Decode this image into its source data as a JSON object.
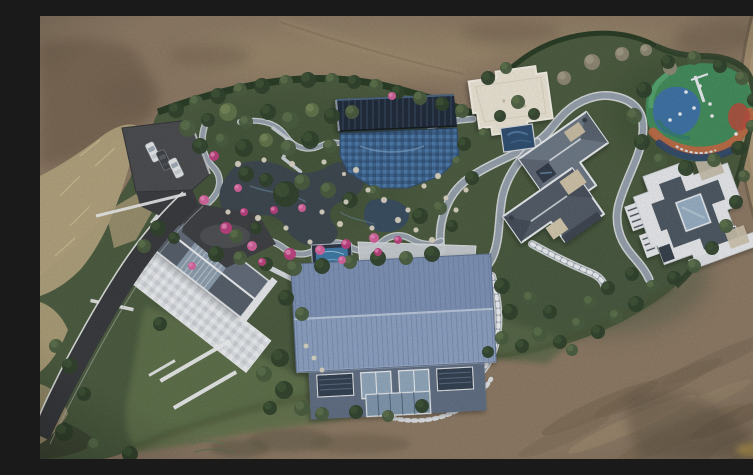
{
  "scene": {
    "description": "Top-down aerial drone photograph of a landscaped private estate: brown earth fields surround a hedged compound containing a rock-edged koi pond garden with pink azaleas, a dark ribbed pavilion, a blue tiled pool, a cream flat-roofed hall, a colorful rubber playground, two gray hip-roof villas, a diagonal gable house with white mosaic terrace, a large blue metal-roof barn, winding gray paths, an asphalt driveway with three parked cars and a dirt road on the right edge",
    "trees": [
      [
        136,
        94,
        8,
        "t1"
      ],
      [
        156,
        86,
        7,
        "t2"
      ],
      [
        178,
        80,
        8,
        "t1"
      ],
      [
        200,
        74,
        7,
        "t2"
      ],
      [
        222,
        70,
        8,
        "t1"
      ],
      [
        246,
        66,
        7,
        "t2"
      ],
      [
        268,
        64,
        8,
        "t1"
      ],
      [
        292,
        64,
        7,
        "t2"
      ],
      [
        314,
        66,
        7,
        "t1"
      ],
      [
        336,
        70,
        7,
        "t2"
      ],
      [
        358,
        76,
        7,
        "t1"
      ],
      [
        380,
        82,
        7,
        "t2"
      ],
      [
        402,
        88,
        7,
        "t1"
      ],
      [
        422,
        95,
        7,
        "t2"
      ],
      [
        148,
        112,
        9,
        "t2"
      ],
      [
        168,
        104,
        7,
        "t1"
      ],
      [
        188,
        96,
        9,
        "t3"
      ],
      [
        206,
        106,
        7,
        "t2"
      ],
      [
        228,
        96,
        8,
        "t1"
      ],
      [
        250,
        104,
        9,
        "t2"
      ],
      [
        272,
        94,
        7,
        "t3"
      ],
      [
        292,
        100,
        8,
        "t1"
      ],
      [
        312,
        96,
        7,
        "t2"
      ],
      [
        160,
        130,
        8,
        "t1"
      ],
      [
        182,
        124,
        7,
        "t2"
      ],
      [
        204,
        132,
        9,
        "t1"
      ],
      [
        226,
        124,
        7,
        "t3"
      ],
      [
        248,
        132,
        8,
        "t2"
      ],
      [
        270,
        124,
        9,
        "t1"
      ],
      [
        290,
        130,
        7,
        "t2"
      ],
      [
        246,
        178,
        13,
        "t1"
      ],
      [
        262,
        166,
        8,
        "t2"
      ],
      [
        226,
        164,
        7,
        "t1"
      ],
      [
        288,
        174,
        8,
        "t2"
      ],
      [
        206,
        158,
        8,
        "t1"
      ],
      [
        310,
        184,
        8,
        "t1"
      ],
      [
        334,
        176,
        7,
        "t2"
      ],
      [
        196,
        220,
        7,
        "t2"
      ],
      [
        216,
        212,
        6,
        "t1"
      ],
      [
        176,
        238,
        8,
        "t1"
      ],
      [
        200,
        242,
        7,
        "t2"
      ],
      [
        226,
        248,
        7,
        "t1"
      ],
      [
        254,
        252,
        8,
        "t2"
      ],
      [
        282,
        250,
        8,
        "t1"
      ],
      [
        310,
        246,
        7,
        "t2"
      ],
      [
        338,
        242,
        8,
        "t1"
      ],
      [
        366,
        242,
        7,
        "t2"
      ],
      [
        392,
        238,
        8,
        "t1"
      ],
      [
        448,
        62,
        7,
        "t1"
      ],
      [
        466,
        52,
        6,
        "t2"
      ],
      [
        524,
        62,
        7,
        "t4"
      ],
      [
        552,
        46,
        8,
        "t4"
      ],
      [
        582,
        38,
        7,
        "t4"
      ],
      [
        606,
        34,
        6,
        "t4"
      ],
      [
        630,
        52,
        7,
        "t4"
      ],
      [
        424,
        128,
        7,
        "t1"
      ],
      [
        418,
        146,
        6,
        "t2"
      ],
      [
        432,
        162,
        7,
        "t1"
      ],
      [
        444,
        118,
        6,
        "t2"
      ],
      [
        460,
        100,
        6,
        "t1"
      ],
      [
        478,
        86,
        7,
        "t2"
      ],
      [
        494,
        98,
        6,
        "t1"
      ],
      [
        604,
        74,
        8,
        "t1"
      ],
      [
        594,
        100,
        8,
        "t2"
      ],
      [
        602,
        126,
        8,
        "t1"
      ],
      [
        620,
        144,
        7,
        "t2"
      ],
      [
        646,
        152,
        8,
        "t1"
      ],
      [
        674,
        144,
        7,
        "t2"
      ],
      [
        698,
        132,
        7,
        "t1"
      ],
      [
        712,
        110,
        6,
        "t2"
      ],
      [
        714,
        84,
        7,
        "t1"
      ],
      [
        702,
        62,
        7,
        "t2"
      ],
      [
        680,
        50,
        7,
        "t1"
      ],
      [
        654,
        42,
        7,
        "t2"
      ],
      [
        628,
        46,
        7,
        "t1"
      ],
      [
        700,
        132,
        7,
        "t1"
      ],
      [
        704,
        160,
        6,
        "t2"
      ],
      [
        696,
        186,
        7,
        "t1"
      ],
      [
        686,
        210,
        7,
        "t2"
      ],
      [
        672,
        232,
        7,
        "t1"
      ],
      [
        654,
        250,
        7,
        "t2"
      ],
      [
        634,
        262,
        7,
        "t1"
      ],
      [
        612,
        270,
        6,
        "t2"
      ],
      [
        592,
        258,
        7,
        "t1"
      ],
      [
        576,
        300,
        7,
        "t2"
      ],
      [
        596,
        288,
        8,
        "t1"
      ],
      [
        558,
        316,
        7,
        "t1"
      ],
      [
        538,
        308,
        7,
        "t2"
      ],
      [
        520,
        326,
        7,
        "t1"
      ],
      [
        500,
        318,
        8,
        "t2"
      ],
      [
        482,
        330,
        7,
        "t1"
      ],
      [
        462,
        322,
        7,
        "t2"
      ],
      [
        448,
        336,
        6,
        "t1"
      ],
      [
        532,
        334,
        6,
        "t2"
      ],
      [
        470,
        296,
        8,
        "t1"
      ],
      [
        490,
        282,
        7,
        "t2"
      ],
      [
        462,
        270,
        8,
        "t1"
      ],
      [
        510,
        296,
        7,
        "t1"
      ],
      [
        550,
        286,
        7,
        "t2"
      ],
      [
        568,
        272,
        7,
        "t1"
      ],
      [
        240,
        342,
        9,
        "t1"
      ],
      [
        224,
        358,
        8,
        "t2"
      ],
      [
        244,
        374,
        9,
        "t1"
      ],
      [
        262,
        392,
        8,
        "t2"
      ],
      [
        230,
        392,
        7,
        "t1"
      ],
      [
        282,
        398,
        7,
        "t2"
      ],
      [
        316,
        396,
        7,
        "t1"
      ],
      [
        348,
        400,
        6,
        "t2"
      ],
      [
        382,
        390,
        7,
        "t1"
      ],
      [
        118,
        212,
        8,
        "t1"
      ],
      [
        104,
        230,
        7,
        "t2"
      ],
      [
        134,
        222,
        6,
        "t1"
      ],
      [
        246,
        282,
        8,
        "t1"
      ],
      [
        262,
        298,
        7,
        "t2"
      ],
      [
        120,
        308,
        7,
        "t1"
      ],
      [
        30,
        350,
        8,
        "t1"
      ],
      [
        16,
        330,
        7,
        "t2"
      ],
      [
        44,
        378,
        7,
        "t1"
      ],
      [
        24,
        416,
        9,
        "t1"
      ],
      [
        56,
        430,
        9,
        "t2"
      ],
      [
        90,
        438,
        8,
        "t1"
      ],
      [
        744,
        366,
        9,
        "t1"
      ],
      [
        752,
        384,
        7,
        "t2"
      ],
      [
        380,
        200,
        8,
        "t1"
      ],
      [
        400,
        192,
        7,
        "t2"
      ],
      [
        412,
        210,
        6,
        "t1"
      ]
    ],
    "flowers": [
      [
        174,
        140,
        5
      ],
      [
        164,
        184,
        5
      ],
      [
        186,
        212,
        6
      ],
      [
        212,
        230,
        5
      ],
      [
        250,
        238,
        6
      ],
      [
        280,
        234,
        5
      ],
      [
        306,
        228,
        5
      ],
      [
        334,
        222,
        5
      ],
      [
        358,
        224,
        4
      ],
      [
        262,
        192,
        4
      ],
      [
        234,
        194,
        4
      ],
      [
        198,
        172,
        4
      ],
      [
        222,
        246,
        4
      ],
      [
        302,
        244,
        4
      ],
      [
        338,
        236,
        4
      ],
      [
        152,
        250,
        4
      ],
      [
        204,
        196,
        4
      ],
      [
        352,
        80,
        4
      ]
    ],
    "stones": [
      [
        198,
        148,
        3
      ],
      [
        224,
        144,
        2.5
      ],
      [
        252,
        148,
        3
      ],
      [
        284,
        146,
        2.5
      ],
      [
        316,
        154,
        3
      ],
      [
        328,
        174,
        2.5
      ],
      [
        300,
        208,
        3
      ],
      [
        270,
        226,
        2.5
      ],
      [
        246,
        212,
        2.5
      ],
      [
        218,
        202,
        3
      ],
      [
        188,
        196,
        2.5
      ],
      [
        304,
        158,
        2
      ],
      [
        344,
        184,
        3
      ],
      [
        368,
        194,
        2.5
      ],
      [
        384,
        170,
        2.5
      ],
      [
        398,
        160,
        3
      ],
      [
        406,
        182,
        2.5
      ],
      [
        358,
        204,
        3
      ],
      [
        332,
        212,
        2.5
      ],
      [
        376,
        214,
        2.5
      ],
      [
        392,
        224,
        3
      ],
      [
        416,
        194,
        2.5
      ],
      [
        426,
        174,
        2.5
      ],
      [
        306,
        186,
        2.5
      ],
      [
        282,
        196,
        2.5
      ],
      [
        266,
        330,
        2.5
      ],
      [
        274,
        342,
        2.5
      ],
      [
        282,
        354,
        2.5
      ]
    ],
    "cars": [
      {
        "x": 113,
        "y": 136,
        "a": -26,
        "c": "white"
      },
      {
        "x": 124,
        "y": 144,
        "a": -26,
        "c": "dark"
      },
      {
        "x": 136,
        "y": 152,
        "a": -26,
        "c": "white"
      }
    ]
  },
  "palette": {
    "dirt_base": "#8b7760",
    "dirt_dark": "#6f5d49",
    "dirt_light": "#a3906d",
    "dirt_road": "#a18c6c",
    "estate_green": "#47583a",
    "lawn_green": "#5d6f46",
    "hedge_dark": "#24381f",
    "tan_grass": "#b2a27a",
    "asphalt": "#37393b",
    "path_gray": "#94a0ab",
    "path_curb": "#e3e6e9",
    "pond_dark": "#39434a",
    "pool_blue": "#39618c",
    "pavilion_dark": "#1d2836",
    "flower_pink": "#bf3c7c",
    "flower_pink_light": "#d9609c",
    "stone_white": "#ded7c6",
    "cream_roof": "#ece5d4",
    "roof_gray": "#5c6670",
    "roof_dark": "#4a545e",
    "roof_white": "#e8eaec",
    "terrace_light": "#dfe2e5",
    "barn_roof": "#7b91b4",
    "barn_roof_light": "#8ba1c1",
    "barn_wall": "#5d6c80",
    "glass_blue": "#96adc2",
    "playground_green": "#3f8a57",
    "playground_blue": "#3a6fa8",
    "playground_orange": "#c2663e",
    "playground_red": "#b34a3a",
    "playground_navy": "#2c4166",
    "car_white": "#e6e8e8",
    "car_dark": "#3b3e41",
    "water_teal": "#3a77a4",
    "tree_shades": {
      "t1": [
        "#2c3e27",
        "#3e5433"
      ],
      "t2": [
        "#46593a",
        "#5d7349"
      ],
      "t3": [
        "#5f7247",
        "#798a58"
      ],
      "t4": [
        "#8f8872",
        "#a79f87"
      ]
    }
  }
}
